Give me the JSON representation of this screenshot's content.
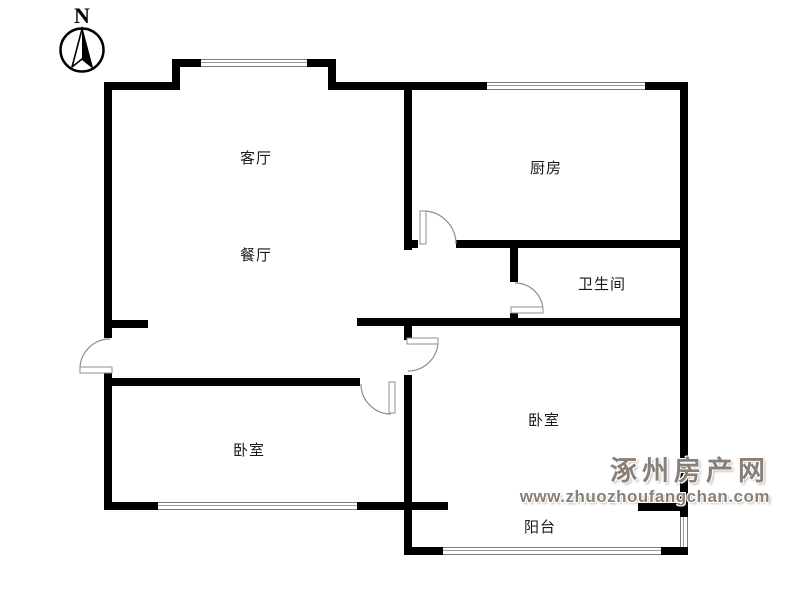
{
  "compass": {
    "label": "N"
  },
  "rooms": {
    "living": {
      "label": "客厅"
    },
    "dining": {
      "label": "餐厅"
    },
    "kitchen": {
      "label": "厨房"
    },
    "bathroom": {
      "label": "卫生间"
    },
    "bedroom_right": {
      "label": "卧室"
    },
    "bedroom_left": {
      "label": "卧室"
    },
    "balcony": {
      "label": "阳台"
    }
  },
  "watermark": {
    "site_name": "涿州房产网",
    "url": "www.zhuozhoufangchan.com",
    "color": "#8a7f76"
  },
  "colors": {
    "background": "#ffffff",
    "wall": "#000000",
    "door_line": "#8f8f8f",
    "window_line": "#7d7d7d"
  }
}
